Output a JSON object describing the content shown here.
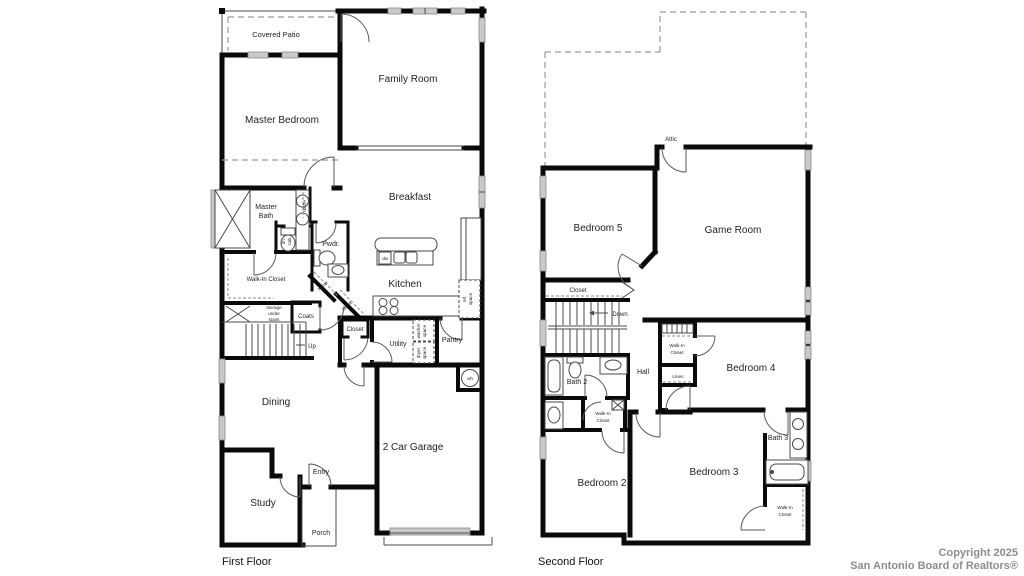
{
  "watermark": {
    "line1": "Copyright 2025",
    "line2": "San Antonio Board of Realtors®"
  },
  "colors": {
    "wall": "#0a0a0a",
    "window_fill": "#c9c9c9",
    "background": "#ffffff",
    "watermark": "#8d8d8d"
  },
  "first_floor": {
    "caption": "First Floor",
    "labels": {
      "covered_patio": "Covered Patio",
      "family_room": "Family Room",
      "master_bedroom": "Master Bedroom",
      "master_bath_l1": "Master",
      "master_bath_l2": "Bath",
      "niche_bath": "Niche",
      "lin_cab_l1": "lin.",
      "lin_cab_l2": "cab.",
      "pwdr": "Pwdr.",
      "walk_in_closet": "Walk-In Closet",
      "breakfast": "Breakfast",
      "kitchen": "Kitchen",
      "dw": "dw",
      "niche_hall_1": "Niche",
      "niche_hall_2": "Niche",
      "coats": "Coats",
      "storage_l1": "storage",
      "storage_l2": "under",
      "storage_l3": "stairs",
      "up": "Up",
      "closet": "Closet",
      "utility": "Utility",
      "washer_l1": "washer",
      "washer_l2": "space",
      "dryer_l1": "dryer",
      "dryer_l2": "space",
      "pantry": "Pantry",
      "ref_l1": "ref.",
      "ref_l2": "space",
      "dining": "Dining",
      "garage": "2 Car Garage",
      "wh": "wh",
      "entry": "Entry",
      "study": "Study",
      "porch": "Porch"
    }
  },
  "second_floor": {
    "caption": "Second Floor",
    "labels": {
      "attic": "Attic",
      "bedroom5": "Bedroom 5",
      "game_room": "Game Room",
      "closet": "Closet",
      "down": "Down",
      "bath2": "Bath 2",
      "hall": "Hall",
      "wic_b4_l1": "Walk-In",
      "wic_b4_l2": "Closet",
      "linen": "Linen",
      "bedroom4": "Bedroom 4",
      "wic_b2_l1": "Walk-In",
      "wic_b2_l2": "Closet",
      "bedroom2": "Bedroom 2",
      "bedroom3": "Bedroom 3",
      "bath3": "Bath 3",
      "wic_b3_l1": "Walk-In",
      "wic_b3_l2": "Closet"
    }
  }
}
